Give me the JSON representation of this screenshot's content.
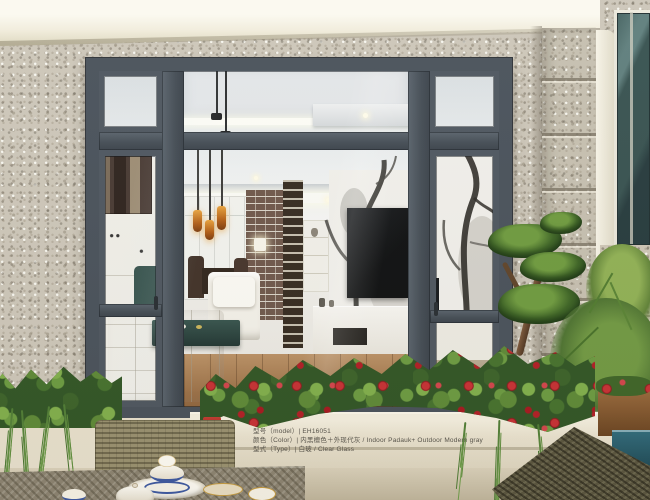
{
  "caption": {
    "lines": [
      "型号（model）| EH16051",
      "颜色（Color）| 内黑檀色＋外现代灰 / Indoor Padauk+ Outdoor Modern gray",
      "型式（Type）| 白玻 / Clear Glass"
    ]
  },
  "colors": {
    "window_frame": "#47505a",
    "granite_wall": "#ccc6b9",
    "cornice": "#f3f0e2",
    "foliage_green": "#3f6b2c",
    "flower_red": "#b01c24",
    "stone_planter": "#e9e3d2",
    "rattan_dark": "#57533d",
    "wood_floor": "#9c6c3f",
    "water_teal": "#2a6374",
    "amber_pendant": "#d98a2b"
  }
}
